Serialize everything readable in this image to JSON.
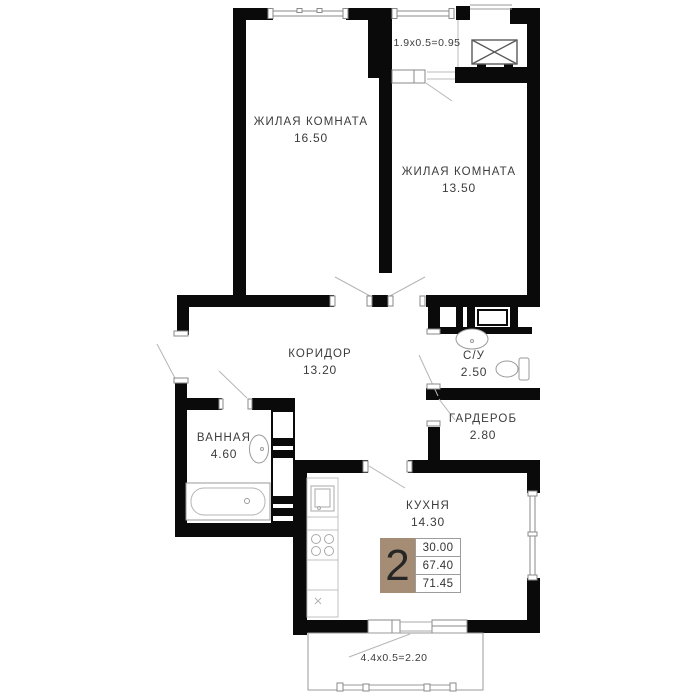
{
  "plan": {
    "rooms": {
      "living1": {
        "name": "ЖИЛАЯ КОМНАТА",
        "area": "16.50"
      },
      "living2": {
        "name": "ЖИЛАЯ КОМНАТА",
        "area": "13.50"
      },
      "corridor": {
        "name": "КОРИДОР",
        "area": "13.20"
      },
      "wc": {
        "name": "С/У",
        "area": "2.50"
      },
      "wardrobe": {
        "name": "ГАРДЕРОБ",
        "area": "2.80"
      },
      "bathroom": {
        "name": "ВАННАЯ",
        "area": "4.60"
      },
      "kitchen": {
        "name": "КУХНЯ",
        "area": "14.30"
      }
    },
    "balconies": {
      "top": {
        "label": "1.9x0.5=0.95"
      },
      "bottom": {
        "label": "4.4x0.5=2.20"
      }
    },
    "summary": {
      "rooms_count": "2",
      "values": [
        "30.00",
        "67.40",
        "71.45"
      ]
    },
    "colors": {
      "wall": "#0a0a0a",
      "badge": "#a58c74",
      "text": "#3c3c3c"
    }
  }
}
